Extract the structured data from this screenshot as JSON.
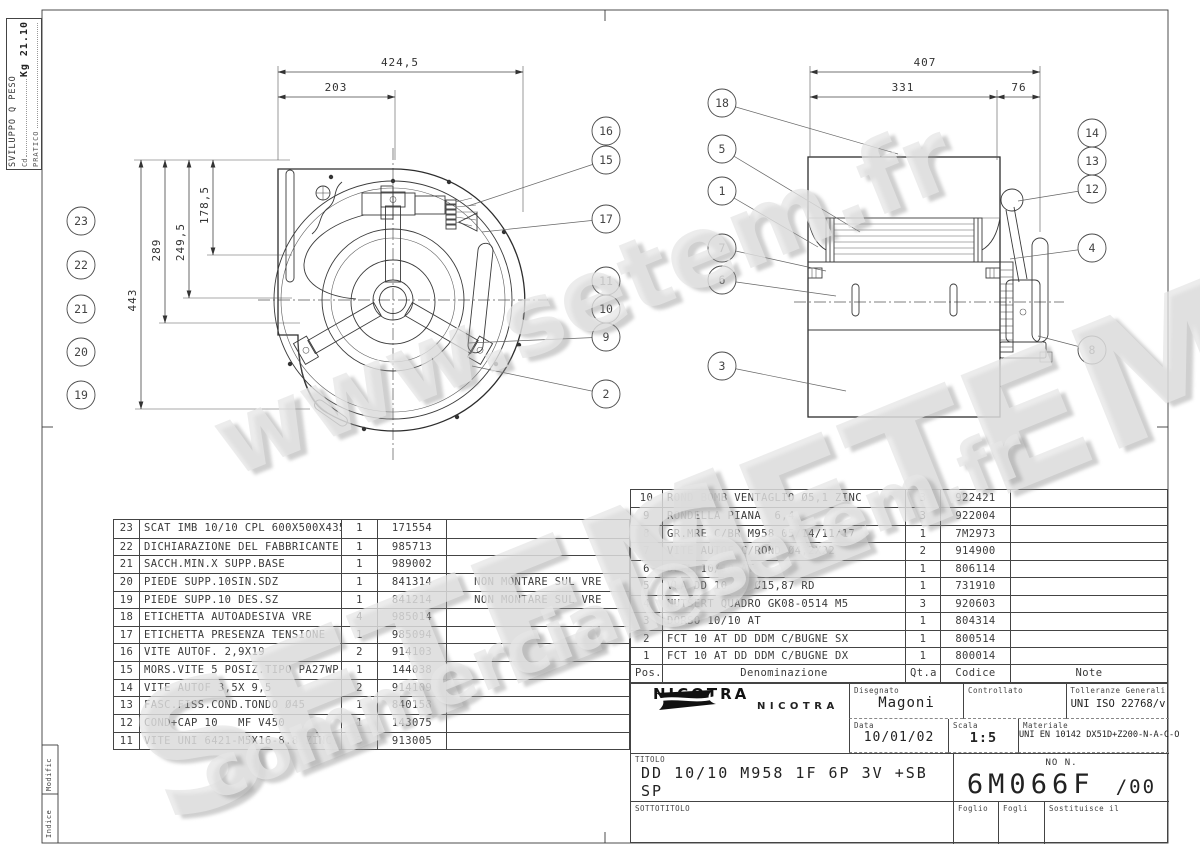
{
  "corner_box": {
    "line1": "SVILUPPO Q PESO",
    "line2_label": "Cd",
    "line2_value": "Kg 21.10",
    "line3": "PRATICO"
  },
  "edge_labels": {
    "modific": "Modific",
    "indice": "Indice"
  },
  "watermark": {
    "www": "www.setem.fr",
    "big1": "SETEM",
    "big2": "SETEM",
    "email": "commercial@setem.fr",
    "color": "#e6e6e6"
  },
  "left_view": {
    "dim_424": "424,5",
    "dim_203": "203",
    "dim_443": "443",
    "dim_289": "289",
    "dim_249": "249,5",
    "dim_178": "178,5"
  },
  "right_view": {
    "dim_407": "407",
    "dim_331": "331",
    "dim_76": "76"
  },
  "callouts": {
    "lv_right": [
      "16",
      "15",
      "17",
      "11",
      "10",
      "9",
      "2"
    ],
    "lv_left": [
      "23",
      "22",
      "21",
      "20",
      "19"
    ],
    "rv_left": [
      "18",
      "5",
      "1",
      "7",
      "6",
      "3"
    ],
    "rv_right": [
      "14",
      "13",
      "12",
      "4",
      "8"
    ]
  },
  "parts_left": [
    {
      "pos": "23",
      "den": "SCAT IMB 10/10 CPL 600X500X435",
      "qty": "1",
      "code": "171554",
      "note": ""
    },
    {
      "pos": "22",
      "den": "DICHIARAZIONE DEL FABBRICANTE",
      "qty": "1",
      "code": "985713",
      "note": ""
    },
    {
      "pos": "21",
      "den": "SACCH.MIN.X SUPP.BASE",
      "qty": "1",
      "code": "989002",
      "note": ""
    },
    {
      "pos": "20",
      "den": "PIEDE SUPP.10SIN.SDZ",
      "qty": "1",
      "code": "841314",
      "note": "NON MONTARE SUL VRE"
    },
    {
      "pos": "19",
      "den": "PIEDE SUPP.10 DES.SZ",
      "qty": "1",
      "code": "841214",
      "note": "NON MONTARE SUL VRE"
    },
    {
      "pos": "18",
      "den": "ETICHETTA AUTOADESIVA VRE",
      "qty": "4",
      "code": "985014",
      "note": ""
    },
    {
      "pos": "17",
      "den": "ETICHETTA PRESENZA TENSIONE",
      "qty": "1",
      "code": "985094",
      "note": ""
    },
    {
      "pos": "16",
      "den": "VITE AUTOF. 2,9X19",
      "qty": "2",
      "code": "914103",
      "note": ""
    },
    {
      "pos": "15",
      "den": "MORS.VITE 5 POSIZ.TIPO PA27WP",
      "qty": "1",
      "code": "144038",
      "note": ""
    },
    {
      "pos": "14",
      "den": "VITE AUTOF 3,5X 9,5",
      "qty": "2",
      "code": "914109",
      "note": ""
    },
    {
      "pos": "13",
      "den": "FASC.FISS.COND.TONDO Ø45",
      "qty": "1",
      "code": "840158",
      "note": ""
    },
    {
      "pos": "12",
      "den": "COND+CAP 10   MF V450",
      "qty": "1",
      "code": "143075",
      "note": ""
    },
    {
      "pos": "11",
      "den": "VITE UNI 6421-M5X16-8.8 ZINC.",
      "qty": "3",
      "code": "913005",
      "note": ""
    }
  ],
  "parts_right": {
    "headers": {
      "pos": "Pos.",
      "den": "Denominazione",
      "qty": "Qt.a",
      "code": "Codice",
      "note": "Note"
    },
    "rows": [
      {
        "pos": "10",
        "den": "ROND BOMB VENTAGLIO Ø5,1 ZINC",
        "qty": "3",
        "code": "922421",
        "note": ""
      },
      {
        "pos": "9",
        "den": "RONDELLA PIANA  6,4",
        "qty": "3",
        "code": "922004",
        "note": ""
      },
      {
        "pos": "8",
        "den": "GR.MRE C/BR M958 05/14/11/17",
        "qty": "1",
        "code": "7M2973",
        "note": ""
      },
      {
        "pos": "7",
        "den": "VITE AUTOF C/ROND Ø4,2X22",
        "qty": "2",
        "code": "914900",
        "note": ""
      },
      {
        "pos": "6",
        "den": "DEFL 10/10 AT",
        "qty": "1",
        "code": "806114",
        "note": ""
      },
      {
        "pos": "5",
        "den": "VLA DD 10/10 Ø15,87 RD",
        "qty": "1",
        "code": "731910",
        "note": ""
      },
      {
        "pos": "4",
        "den": "NUTSERT QUADRO GK08-0514 M5",
        "qty": "3",
        "code": "920603",
        "note": ""
      },
      {
        "pos": "3",
        "den": "DORSO 10/10 AT",
        "qty": "1",
        "code": "804314",
        "note": ""
      },
      {
        "pos": "2",
        "den": "FCT 10 AT DD DDM C/BUGNE SX",
        "qty": "1",
        "code": "800514",
        "note": ""
      },
      {
        "pos": "1",
        "den": "FCT 10 AT DD DDM C/BUGNE DX",
        "qty": "1",
        "code": "800014",
        "note": ""
      }
    ]
  },
  "title_block": {
    "brand": "NICOTRA",
    "brand_secondary": "NICOTRA",
    "disegnato_label": "Disegnato",
    "disegnato": "Magoni",
    "controllato_label": "Controllato",
    "controllato": "",
    "tolleranze_label": "Tolleranze Generali",
    "tolleranze": "UNI ISO 22768/v",
    "data_label": "Data",
    "data": "10/01/02",
    "scala_label": "Scala",
    "scala": "1:5",
    "materiale_label": "Materiale",
    "materiale": "UNI EN 10142 DX51D+Z200-N-A-C-O",
    "titolo_label": "TITOLO",
    "titolo": "DD 10/10 M958 1F 6P 3V +SB SP",
    "sottotitolo_label": "SOTTOTITOLO",
    "sottotitolo": "",
    "no_label": "NO N.",
    "drawing_no": "6M066F",
    "revision": "/00",
    "foglio_label": "Foglio",
    "foglio": "",
    "fogli_label": "Fogli",
    "fogli": "",
    "sostituisce_label": "Sostituisce il",
    "sostituisce": ""
  }
}
